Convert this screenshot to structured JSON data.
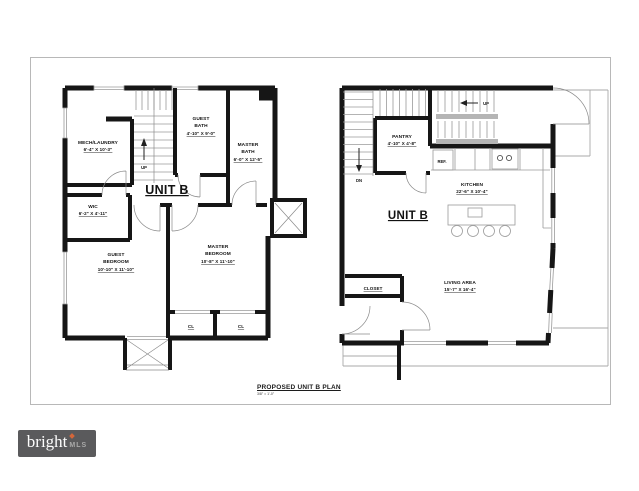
{
  "title_block": {
    "title": "PROPOSED UNIT B PLAN",
    "scale": "3/8\" = 1'-0\""
  },
  "watermark": {
    "brand": "bright",
    "suffix": "MLS",
    "bg_color": "#5a5a5c",
    "accent_color": "#d4663a"
  },
  "colors": {
    "wall": "#161616",
    "thin_line": "#9a9a9a",
    "frame_border": "#b8b8b8",
    "background": "#ffffff"
  },
  "plans": [
    {
      "floor": "upper floor plan (left)",
      "unit_label": "UNIT B",
      "stairs": {
        "up": "UP"
      },
      "rooms": [
        {
          "name": "MECH/LAUNDRY",
          "dims": "6'-4\" X 10'-3\""
        },
        {
          "name": "GUEST BATH",
          "lines": [
            "GUEST",
            "BATH"
          ],
          "dims": "4'-10\" X 9'-0\""
        },
        {
          "name": "MASTER BATH",
          "lines": [
            "MASTER",
            "BATH"
          ],
          "dims": "6'-0\" X 12'-5\""
        },
        {
          "name": "WIC",
          "dims": "6'-2\" X 4'-11\""
        },
        {
          "name": "GUEST BEDROOM",
          "lines": [
            "GUEST",
            "BEDROOM"
          ],
          "dims": "10'-10\" X 11'-10\""
        },
        {
          "name": "MASTER BEDROOM",
          "lines": [
            "MASTER",
            "BEDROOM"
          ],
          "dims": "10'-8\" X 11'-10\""
        },
        {
          "name": "CL"
        },
        {
          "name": "CL"
        }
      ]
    },
    {
      "floor": "main floor plan (right)",
      "unit_label": "UNIT B",
      "stairs": {
        "up": "UP",
        "dn": "DN"
      },
      "appliances": {
        "ref": "REF."
      },
      "rooms": [
        {
          "name": "PANTRY",
          "dims": "4'-10\" X 4'-8\""
        },
        {
          "name": "KITCHEN",
          "dims": "22'-6\" X 10'-4\""
        },
        {
          "name": "LIVING AREA",
          "dims": "15'-7\" X 16'-4\""
        },
        {
          "name": "CLOSET"
        }
      ]
    }
  ]
}
